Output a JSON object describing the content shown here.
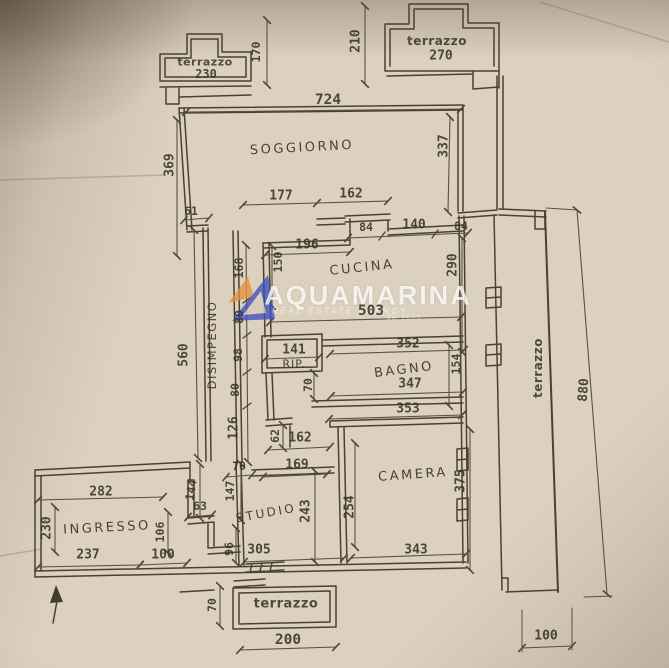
{
  "watermark": {
    "brand": "AQUAMARINA",
    "subtitle": "REAL ESTATE AGENCY",
    "tagline": "dal 2003",
    "logo_blue": "#3c50bd",
    "logo_orange": "#e6923a"
  },
  "palette": {
    "paper": "#d9cdbb",
    "ink": "#453c2e",
    "watermark_text": "#ffffff"
  },
  "rooms": {
    "terrazzo_top_left": {
      "label": "terrazzo",
      "size": "230"
    },
    "terrazzo_top_right": {
      "label": "terrazzo",
      "size": "270"
    },
    "soggiorno": {
      "label": "SOGGIORNO"
    },
    "cucina": {
      "label": "CUCINA"
    },
    "disimpegno": {
      "label": "DISIMPEGNO"
    },
    "rip": {
      "label": "RIP."
    },
    "bagno": {
      "label": "BAGNO"
    },
    "camera": {
      "label": "CAMERA"
    },
    "studio": {
      "label": "STUDIO"
    },
    "ingresso": {
      "label": "INGRESSO"
    },
    "terrazzo_bottom": {
      "label": "terrazzo"
    },
    "terrazzo_right": {
      "label": "terrazzo"
    }
  },
  "dims": {
    "d170": "170",
    "d210": "210",
    "d724": "724",
    "d369": "369",
    "d337": "337",
    "d177": "177",
    "d162_top": "162",
    "d61": "61",
    "d84_left": "84",
    "d140": "140",
    "d84_right": "84",
    "d196": "196",
    "d150": "150",
    "d168": "168",
    "d290": "290",
    "d560": "560",
    "d80_upper": "80",
    "d98": "98",
    "d141": "141",
    "d352": "352",
    "d503": "503",
    "d154": "154",
    "d70_bagno": "70",
    "d347": "347",
    "d80_lower": "80",
    "d353": "353",
    "d126": "126",
    "d62": "62",
    "d162_camera": "162",
    "d70_studio_door": "70",
    "d169": "169",
    "d144": "144",
    "d147": "147",
    "d63": "63",
    "d106": "106",
    "d96": "96",
    "d282": "282",
    "d230_ingresso": "230",
    "d237": "237",
    "d100_ingresso": "100",
    "d243": "243",
    "d254": "254",
    "d375": "375",
    "d305": "305",
    "d343": "343",
    "d880": "880",
    "d200": "200",
    "d70_terrazzo": "70",
    "d100_right": "100"
  }
}
